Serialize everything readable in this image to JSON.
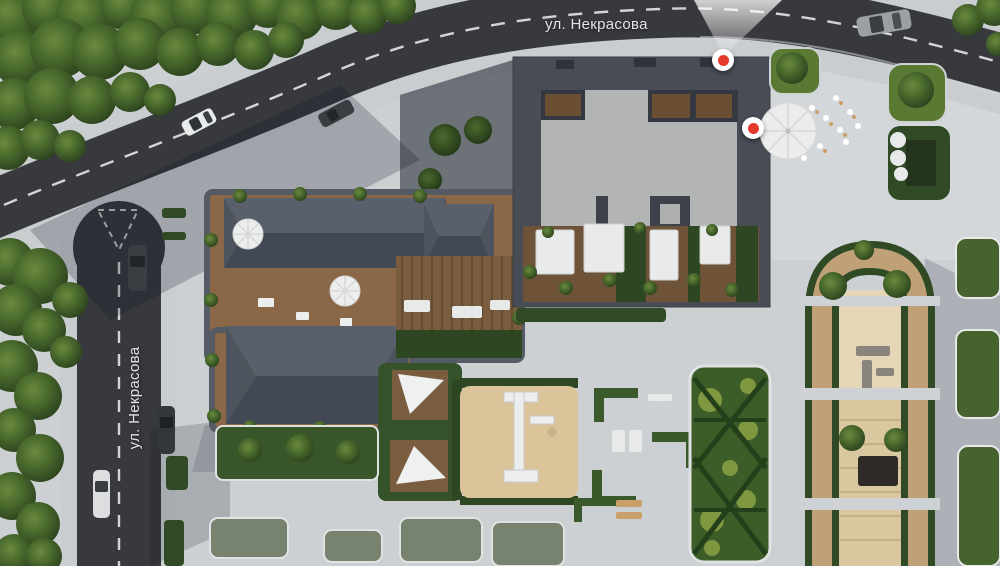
{
  "map": {
    "streets": {
      "top_label": "ул. Некрасова",
      "left_label": "ул. Некрасова"
    },
    "markers": {
      "accent_color": "#e5392c",
      "items": [
        {
          "id": "marker-building-north"
        },
        {
          "id": "marker-building-east"
        }
      ]
    }
  }
}
